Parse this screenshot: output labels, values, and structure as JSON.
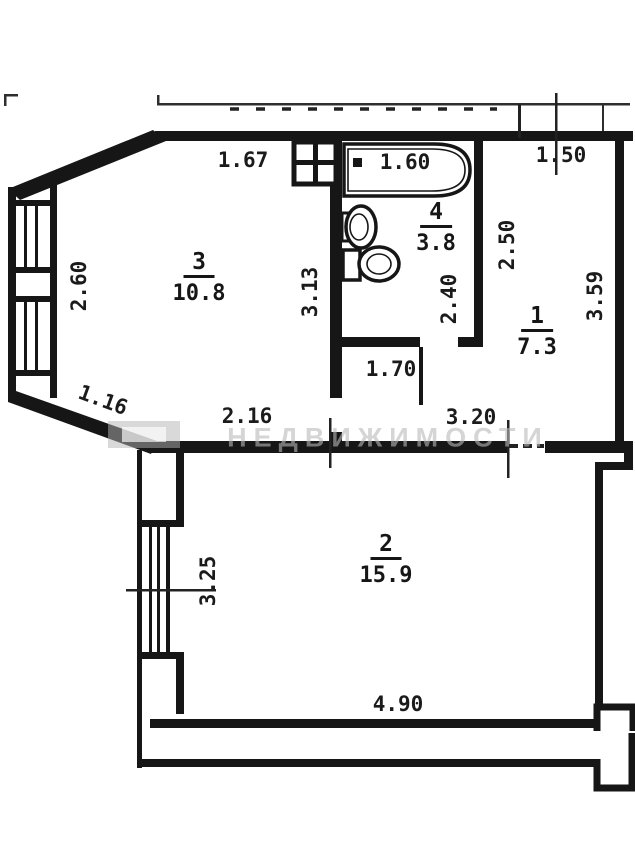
{
  "plan": {
    "title": "apartment-floor-plan",
    "watermark": "НЕДВИЖИМОСТИ",
    "rooms": {
      "room1": {
        "number": "1",
        "area": "7.3"
      },
      "room2": {
        "number": "2",
        "area": "15.9"
      },
      "room3": {
        "number": "3",
        "area": "10.8"
      },
      "room4": {
        "number": "4",
        "area": "3.8"
      }
    },
    "dimensions": {
      "room3_top": "1.67",
      "bathtub": "1.60",
      "hall_top": "1.50",
      "room3_left": "2.60",
      "room3_right": "3.13",
      "bay_diagonal": "1.16",
      "room3_bottom": "2.16",
      "bath_height": "2.40",
      "hall_left": "2.50",
      "hall_right": "3.59",
      "corridor": "1.70",
      "hall_bottom": "3.20",
      "room2_left": "3.25",
      "room2_bottom": "4.90"
    },
    "colors": {
      "wall": "#161616",
      "thin_line": "#2e2e2e",
      "background": "#ffffff",
      "watermark": "#b9b9b9"
    }
  }
}
